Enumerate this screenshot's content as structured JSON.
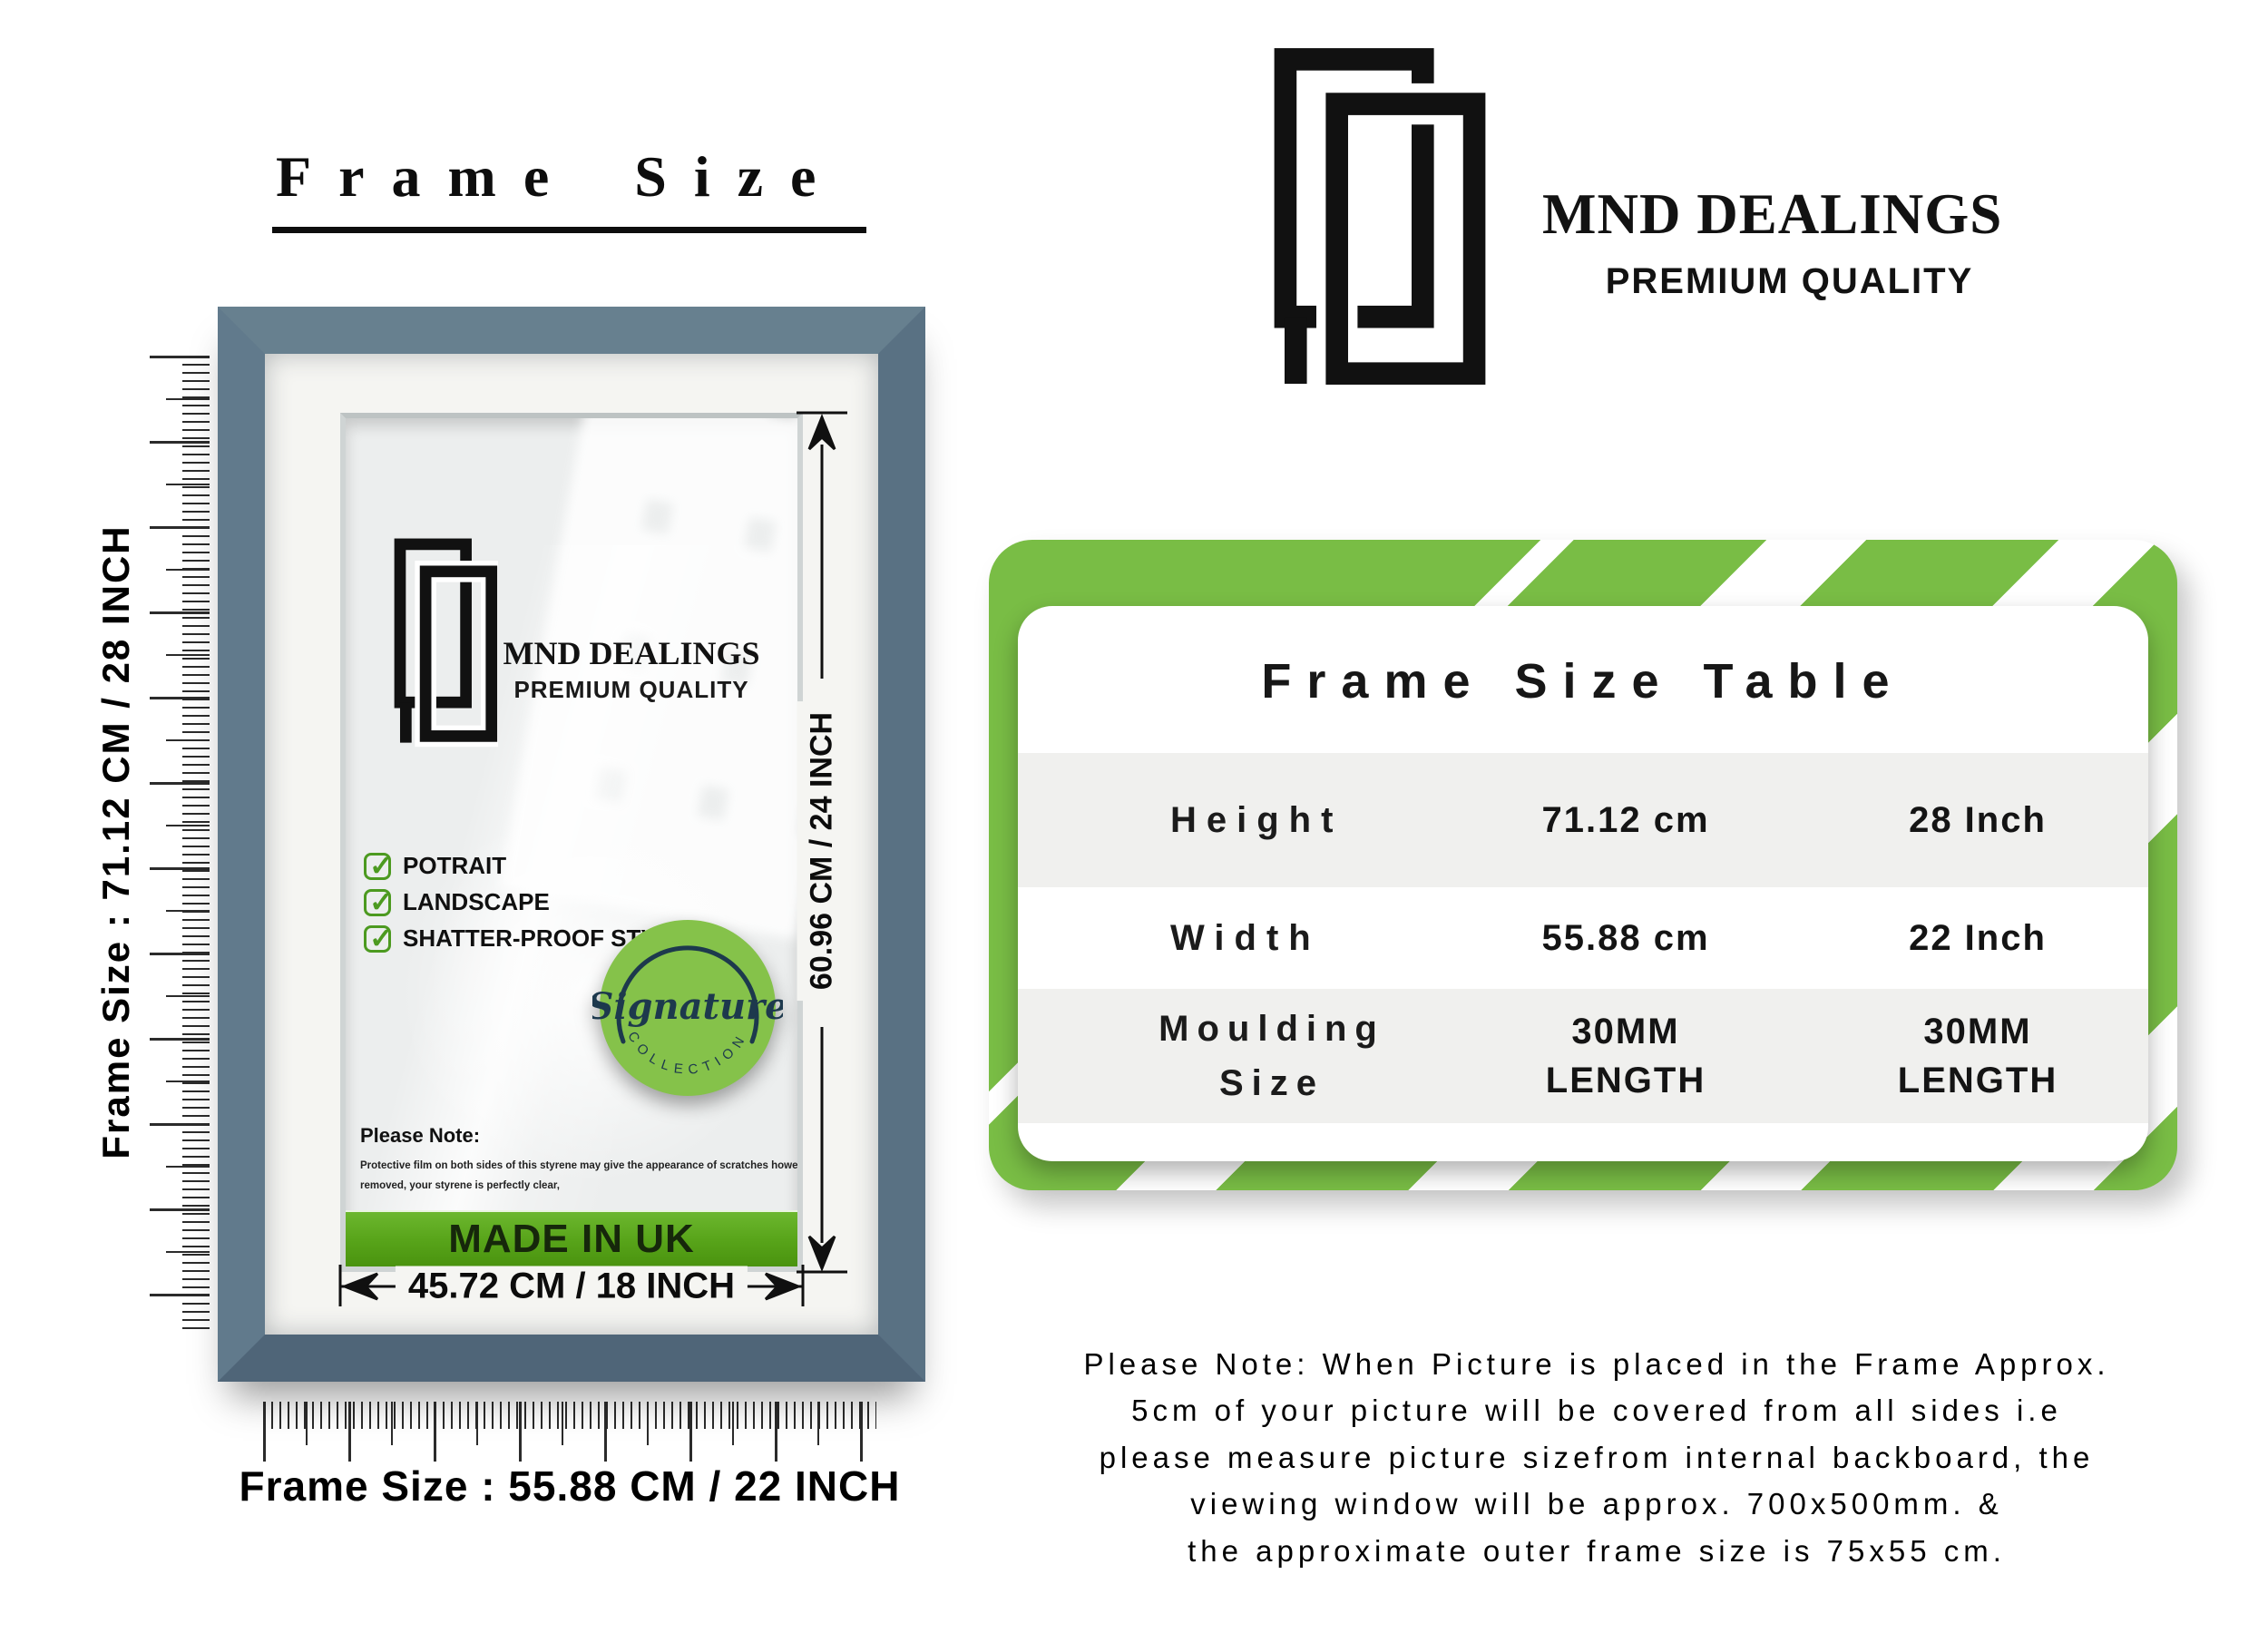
{
  "title": "Frame Size",
  "frame_panel": {
    "vertical_size_label": "Frame Size : 71.12 CM / 28 INCH",
    "horizontal_size_label": "Frame Size : 55.88 CM / 22 INCH",
    "inner_vertical_dim": "60.96 CM / 24 INCH",
    "inner_horizontal_dim": "45.72 CM / 18 INCH",
    "logo": {
      "name": "MND DEALINGS",
      "tagline": "PREMIUM QUALITY"
    },
    "features": [
      "POTRAIT",
      "LANDSCAPE",
      "SHATTER-PROOF STYRENE"
    ],
    "badge": {
      "word": "Signature",
      "arc_text": "COLLECTION"
    },
    "note_title": "Please Note:",
    "note_line1": "Protective film on both sides of this styrene may give the appearance of scratches however once",
    "note_line2": "removed, your styrene is perfectly clear,",
    "made_in": "MADE IN UK"
  },
  "brand": {
    "name": "MND DEALINGS",
    "tagline": "PREMIUM QUALITY"
  },
  "size_table": {
    "title": "Frame Size Table",
    "rows": [
      {
        "label": "Height",
        "metric": "71.12 cm",
        "imperial": "28 Inch"
      },
      {
        "label": "Width",
        "metric": "55.88 cm",
        "imperial": "22 Inch"
      },
      {
        "label": "Moulding Size",
        "metric": "30MM LENGTH",
        "imperial": "30MM LENGTH"
      }
    ]
  },
  "footer_note": {
    "line1": "Please Note: When Picture is placed in the Frame Approx.",
    "line2": "5cm of your picture will be covered from all sides i.e",
    "line3": "please measure picture sizefrom internal backboard, the",
    "line4": "viewing window will be approx. 700x500mm. &",
    "line5": "the approximate outer frame size is 75x55 cm."
  },
  "colors": {
    "frame_blue": "#5d7487",
    "accent_green": "#76b83f",
    "badge_green": "#85c24a",
    "navy": "#1d394d"
  }
}
